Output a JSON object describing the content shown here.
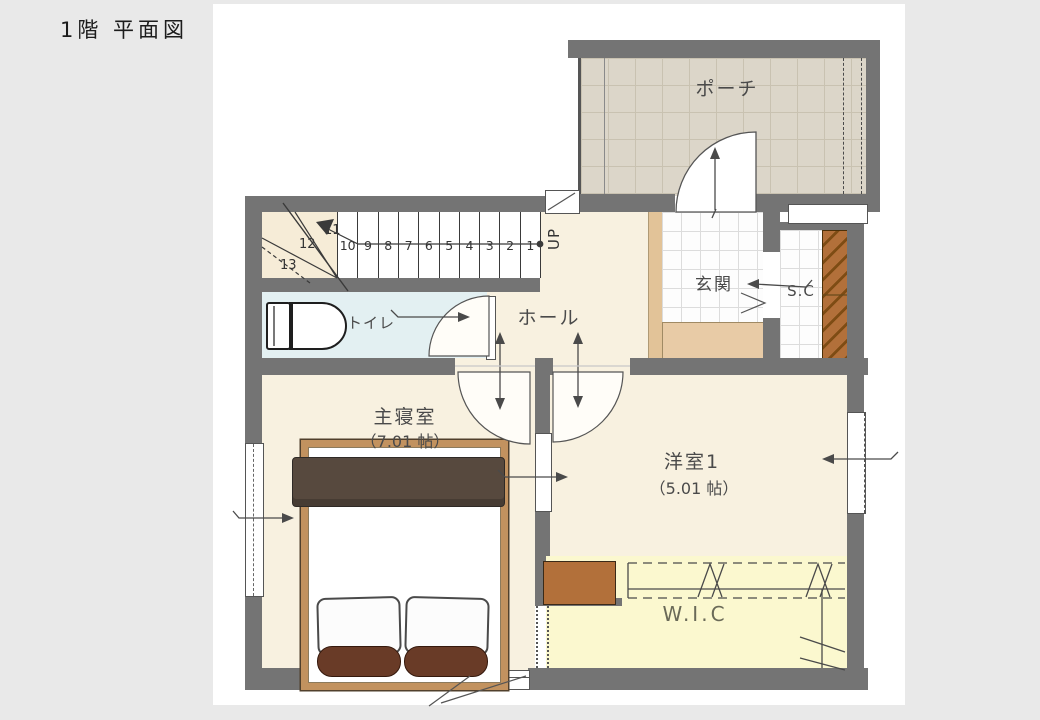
{
  "page": {
    "title": "1階 平面図",
    "background": "#e9e9e9",
    "canvas_background": "#ffffff"
  },
  "rooms": {
    "porch": {
      "label": "ポーチ"
    },
    "entrance": {
      "label": "玄関"
    },
    "shoe_closet": {
      "label": "S.C"
    },
    "toilet": {
      "label": "トイレ"
    },
    "hall": {
      "label": "ホール"
    },
    "master_bedroom": {
      "label": "主寝室",
      "size": "（7.01 帖）"
    },
    "western_room_1": {
      "label": "洋室1",
      "size": "（5.01 帖）"
    },
    "walk_in_closet": {
      "label": "W.I.C"
    }
  },
  "stairs": {
    "up_label": "UP",
    "straight_treads": [
      "1",
      "2",
      "3",
      "4",
      "5",
      "6",
      "7",
      "8",
      "9",
      "10"
    ],
    "winder_treads": [
      "11",
      "12",
      "13"
    ]
  },
  "colors": {
    "wall": "#747474",
    "floor_cream": "#f8f1e0",
    "wic_yellow": "#fbf8cf",
    "toilet_blue": "#e3f0f2",
    "porch_tile": "#dcd6c9",
    "entrance_step": "#e8cba6",
    "sc_shelf_brown": "#b2703a",
    "bed_frame_wood": "#c2925f",
    "blanket_dark": "#57493e",
    "bolster_brown": "#693b27"
  }
}
